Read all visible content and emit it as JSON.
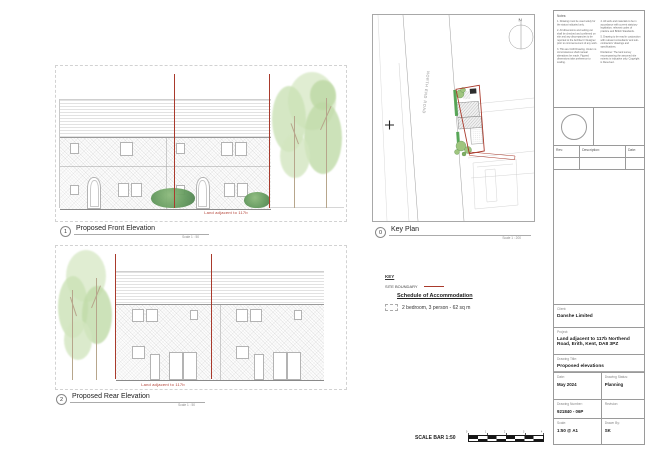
{
  "drawings": {
    "front": {
      "number": "1",
      "title": "Proposed Front Elevation",
      "scale": "Scale 1 : 50",
      "annotation": "Land adjacent to 117b"
    },
    "rear": {
      "number": "2",
      "title": "Proposed Rear Elevation",
      "scale": "Scale 1 : 50",
      "annotation": "Land adjacent to 117b"
    },
    "key_plan": {
      "number": "0",
      "title": "Key Plan",
      "scale": "Scale 1 : 200",
      "road_name": "NORTH END ROAD",
      "north_label": "N"
    }
  },
  "legend": {
    "key_title": "KEY",
    "site_boundary": "SITE BOUNDARY",
    "schedule_title": "Schedule of Accommodation",
    "schedule_item": "2 bedroom, 3 person  - 62 sq m"
  },
  "scale_bar": {
    "label": "SCALE BAR 1:50",
    "ticks": [
      "0",
      "1",
      "2",
      "3",
      "4"
    ]
  },
  "notes": {
    "header": "Notes:",
    "col1": [
      "1.  Drawing must be used solely for the status indicated only.",
      "2.  All dimensions and setting out shall be checked and confirmed on site and any discrepancies to be reported to the Architect / Designer prior to commencement of any work.",
      "3.  This are CAD Drawing. Under no circumstances shall manual alterations be made. Figured dimensions take preference to scaling."
    ],
    "col2": [
      "4.  All work and materials to be in accordance with current statutory legislation, relevant codes of practice and British Standards.",
      "5.  Drawing to be read in conjunction with relevant consultants' and sub-contractors' drawings and specifications.",
      "Disclaimer:  The land survey encompassing the assumed site extents is indicative only. Copyright is Reserved."
    ]
  },
  "title_block": {
    "rev_label": "Rev:",
    "description_label": "Description:",
    "date_col_label": "Date:",
    "client_label": "Client:",
    "client": "Danshe Limited",
    "project_label": "Project:",
    "project": "Land adjacent to 117b Northend Road, Erith, Kent, DA8 3PZ",
    "drawing_title_label": "Drawing Title:",
    "drawing_title": "Proposed elevations",
    "date_label": "Date:",
    "date": "May 2024",
    "status_label": "Drawing Status:",
    "status": "Planning",
    "number_label": "Drawing Number:",
    "number": "921840 - 06P",
    "revision_label": "Revision:",
    "revision": "",
    "scale_label": "Scale:",
    "scale": "1:50 @ A1",
    "drawn_label": "Drawn By:",
    "drawn_by": "SK"
  },
  "colors": {
    "boundary_red": "#a93a2c",
    "annotation_red": "#b03a2e",
    "hedge_green": "#3f9b3f",
    "tree_green": "#cfe2bd"
  }
}
